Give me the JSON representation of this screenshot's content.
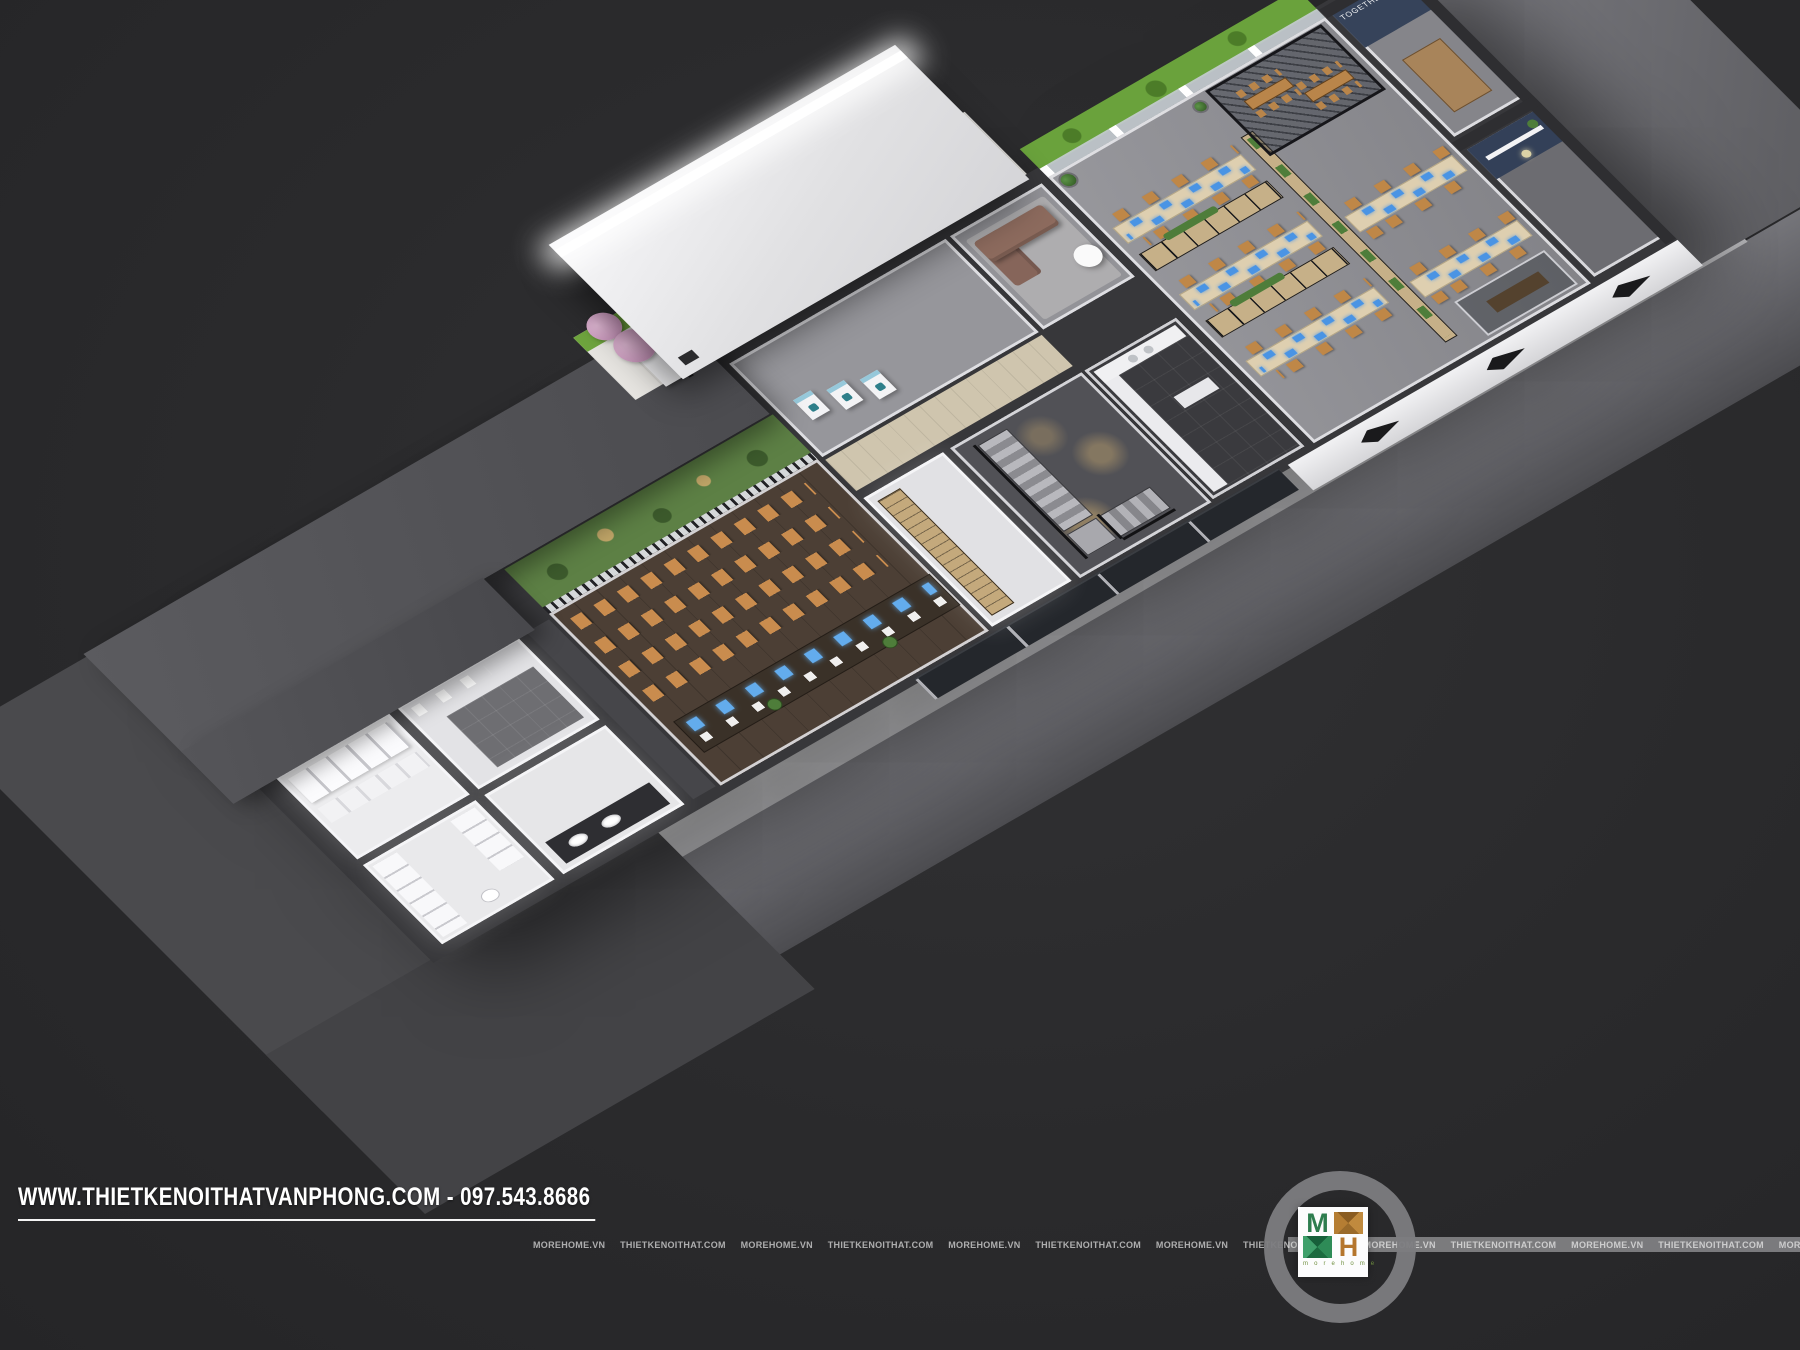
{
  "overlay": {
    "website_label": "WWW.THIETKENOITHATVANPHONG.COM - 097.543.8686",
    "watermark_text": "MOREHOME.VN   THIETKENOITHAT.COM   MOREHOME.VN   THIETKENOITHAT.COM   MOREHOME.VN   THIETKENOITHAT.COM   MOREHOME.VN   THIETKENOITHAT.COM   MOREHOME.VN   THIETKENOITHAT.COM   MOREHOME.VN   THIETKENOITHAT.COM   MOREHOME.VN   THIETKENOITHAT.COM   MOREHOME.VN   THIETKENOITHAT.COM   MOREHOME.VN   THIETKENOITHAT.COM   MOREHOME.VN   THIETKENOITHAT.COM",
    "logo": {
      "letter_m": "M",
      "letter_h": "H",
      "wordmark": "m o r e h o m e",
      "green": "#2e7d4f",
      "orange": "#b5762e",
      "ring_color": "#7c7c7f"
    }
  },
  "scene": {
    "wall_quote": "TOGETHER WE STAND, DIVIDED WE",
    "colors": {
      "background": "#2a2a2c",
      "chair_orange": "#c98c4e",
      "desk_wood": "#decfb0",
      "screen_blue": "#4a94e4",
      "navy_wall": "#36435a",
      "garden_green": "#5d8045",
      "hedge_green": "#6fa53e",
      "blossom_pink": "#d2a2c6",
      "sofa_brown": "#8d6b5e",
      "apron_gray": "#66666a",
      "roof_gray": "#55555a"
    }
  }
}
